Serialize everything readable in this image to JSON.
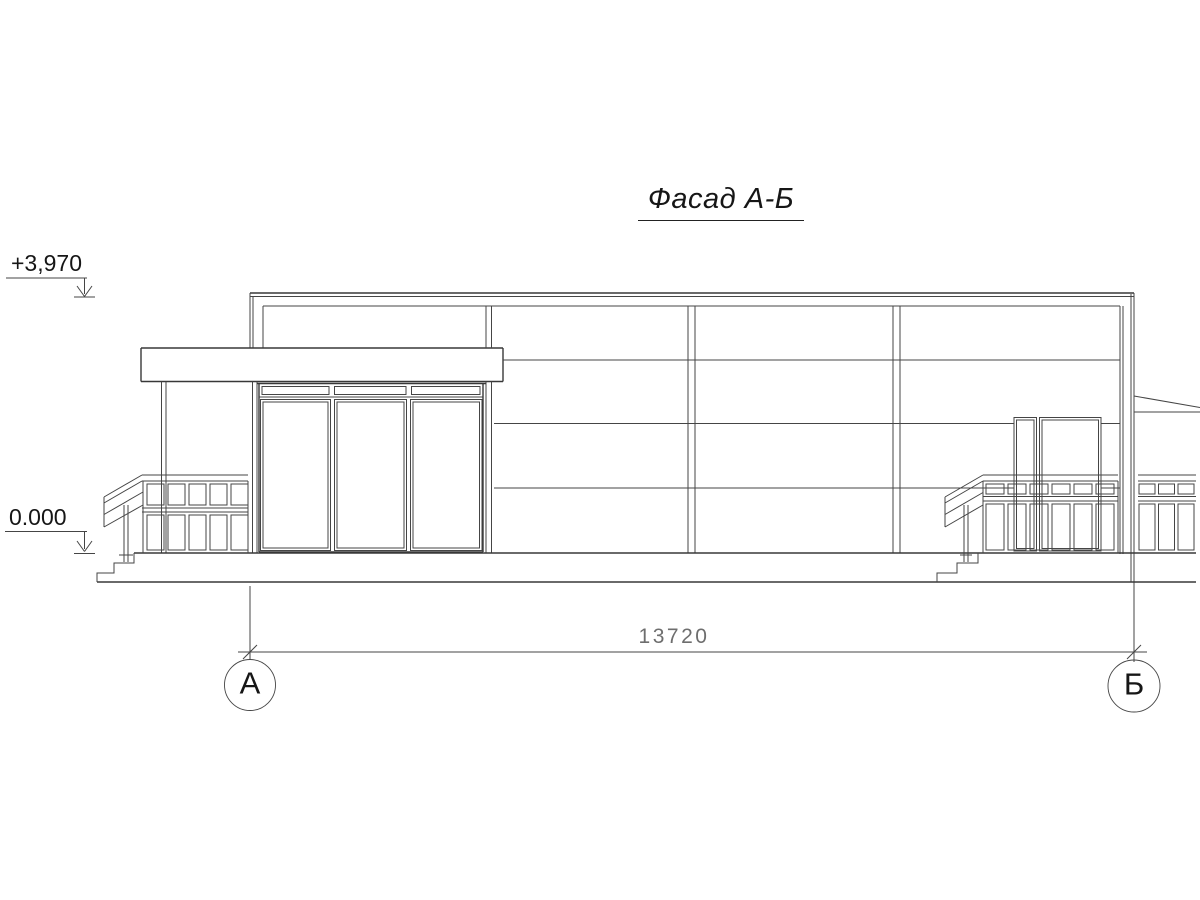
{
  "drawing": {
    "title": "Фасад А-Б",
    "view_type": "facade-elevation",
    "elevations": {
      "top": "+3,970",
      "zero": "0.000"
    },
    "dimension": {
      "value": "13720"
    },
    "axes": {
      "left": "А",
      "right": "Б"
    },
    "colors": {
      "line": "#454545",
      "heavy_line": "#383838",
      "text": "#161616",
      "dim_text": "#6e6e6e",
      "background": "#ffffff"
    }
  }
}
